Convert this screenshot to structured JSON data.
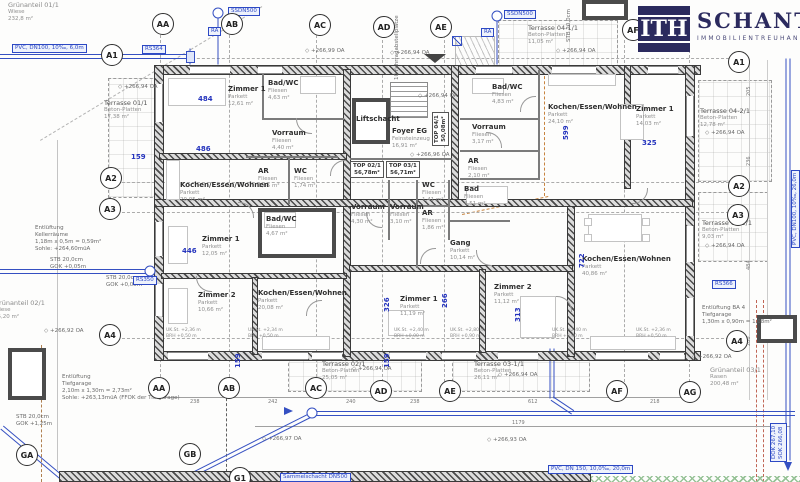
{
  "logo": {
    "monogram": "ITH",
    "name": "SCHANTL",
    "subtitle": "IMMOBILIENTREUHAND"
  },
  "colors": {
    "accent_navy": "#2b2a5e",
    "dim_blue": "#2433bd",
    "pipe_blue": "#3550c2"
  },
  "bubbles": [
    {
      "label": "AA",
      "x": 163,
      "y": 24
    },
    {
      "label": "AB",
      "x": 232,
      "y": 24
    },
    {
      "label": "AC",
      "x": 320,
      "y": 25
    },
    {
      "label": "AD",
      "x": 384,
      "y": 27
    },
    {
      "label": "AE",
      "x": 441,
      "y": 27
    },
    {
      "label": "AF",
      "x": 633,
      "y": 30
    },
    {
      "label": "AA",
      "x": 159,
      "y": 388
    },
    {
      "label": "AB",
      "x": 229,
      "y": 388
    },
    {
      "label": "AC",
      "x": 316,
      "y": 388
    },
    {
      "label": "AD",
      "x": 381,
      "y": 391
    },
    {
      "label": "AE",
      "x": 450,
      "y": 391
    },
    {
      "label": "AF",
      "x": 617,
      "y": 391
    },
    {
      "label": "AG",
      "x": 690,
      "y": 392
    },
    {
      "label": "A1",
      "x": 112,
      "y": 55
    },
    {
      "label": "A2",
      "x": 111,
      "y": 178
    },
    {
      "label": "A3",
      "x": 110,
      "y": 209
    },
    {
      "label": "A4",
      "x": 110,
      "y": 335
    },
    {
      "label": "A1",
      "x": 739,
      "y": 62
    },
    {
      "label": "A2",
      "x": 739,
      "y": 186
    },
    {
      "label": "A3",
      "x": 738,
      "y": 215
    },
    {
      "label": "A4",
      "x": 737,
      "y": 341
    },
    {
      "label": "GA",
      "x": 27,
      "y": 455
    },
    {
      "label": "GB",
      "x": 190,
      "y": 454
    },
    {
      "label": "G1",
      "x": 240,
      "y": 478
    }
  ],
  "rooms": [
    {
      "name": "Zimmer 1",
      "material": "Parkett",
      "area": "12,61 m²",
      "x": 228,
      "y": 86
    },
    {
      "name": "Bad/WC",
      "material": "Fliesen",
      "area": "4,63 m²",
      "x": 268,
      "y": 80
    },
    {
      "name": "Vorraum",
      "material": "Fliesen",
      "area": "4,40 m²",
      "x": 272,
      "y": 130
    },
    {
      "name": "AR",
      "material": "Fliesen",
      "area": "1,85 m²",
      "x": 258,
      "y": 168
    },
    {
      "name": "WC",
      "material": "Fliesen",
      "area": "1,74 m²",
      "x": 294,
      "y": 168
    },
    {
      "name": "Kochen/Essen/Wohnen",
      "material": "Parkett",
      "area": "20,05 m²",
      "x": 180,
      "y": 182
    },
    {
      "name": "Liftschacht",
      "material": "",
      "area": "",
      "x": 356,
      "y": 116
    },
    {
      "name": "Foyer EG",
      "material": "Feinsteinzeug",
      "area": "16,91 m²",
      "x": 392,
      "y": 128
    },
    {
      "name": "Bad/WC",
      "material": "Fliesen",
      "area": "4,83 m²",
      "x": 492,
      "y": 84
    },
    {
      "name": "Vorraum",
      "material": "Fliesen",
      "area": "3,17 m²",
      "x": 472,
      "y": 124
    },
    {
      "name": "AR",
      "material": "Fliesen",
      "area": "2,10 m²",
      "x": 468,
      "y": 158
    },
    {
      "name": "Kochen/Essen/Wohnen",
      "material": "Parkett",
      "area": "24,10 m²",
      "x": 548,
      "y": 104
    },
    {
      "name": "Zimmer 1",
      "material": "Parkett",
      "area": "14,03 m²",
      "x": 636,
      "y": 106
    },
    {
      "name": "Zimmer 1",
      "material": "Parkett",
      "area": "12,05 m²",
      "x": 202,
      "y": 236
    },
    {
      "name": "Zimmer 2",
      "material": "Parkett",
      "area": "10,66 m²",
      "x": 198,
      "y": 292
    },
    {
      "name": "Bad/WC",
      "material": "Fliesen",
      "area": "4,67 m²",
      "x": 266,
      "y": 216
    },
    {
      "name": "Kochen/Essen/Wohnen",
      "material": "Parkett",
      "area": "20,08 m²",
      "x": 258,
      "y": 290
    },
    {
      "name": "Vorraum",
      "material": "Fliesen",
      "area": "4,30 m²",
      "x": 351,
      "y": 204
    },
    {
      "name": "Vorraum",
      "material": "Fliesen",
      "area": "3,10 m²",
      "x": 390,
      "y": 204
    },
    {
      "name": "WC",
      "material": "Fliesen",
      "area": "1,41 m²",
      "x": 422,
      "y": 182
    },
    {
      "name": "AR",
      "material": "Fliesen",
      "area": "1,86 m²",
      "x": 422,
      "y": 210
    },
    {
      "name": "Bad",
      "material": "Fliesen",
      "area": "4,51 m²",
      "x": 464,
      "y": 186
    },
    {
      "name": "Gang",
      "material": "Parkett",
      "area": "10,14 m²",
      "x": 450,
      "y": 240
    },
    {
      "name": "Zimmer 1",
      "material": "Parkett",
      "area": "11,19 m²",
      "x": 400,
      "y": 296
    },
    {
      "name": "Zimmer 2",
      "material": "Parkett",
      "area": "11,12 m²",
      "x": 494,
      "y": 284
    },
    {
      "name": "Kochen/Essen/Wohnen",
      "material": "Parkett",
      "area": "40,86 m²",
      "x": 582,
      "y": 256
    }
  ],
  "tops": [
    {
      "label": "TOP 02/1",
      "area": "56,78m²",
      "x": 350,
      "y": 161,
      "vertical": false
    },
    {
      "label": "TOP 03/1",
      "area": "56,71m²",
      "x": 386,
      "y": 161,
      "vertical": false
    },
    {
      "label": "TOP 04/1",
      "area": "50,08m²",
      "x": 432,
      "y": 146,
      "vertical": true
    }
  ],
  "terraces": [
    {
      "name": "Terrasse 01/1",
      "material": "Beton-Platten",
      "area": "17,38 m²",
      "x": 104,
      "y": 100,
      "rx": 108,
      "ry": 78,
      "rw": 48,
      "rh": 118
    },
    {
      "name": "Terrasse 02/1",
      "material": "Beton-Platten",
      "area": "25,05 m²",
      "x": 322,
      "y": 361,
      "rx": 288,
      "ry": 358,
      "rw": 132,
      "rh": 32
    },
    {
      "name": "Terrasse 03-1/1",
      "material": "Beton-Platten",
      "area": "26,11 m²",
      "x": 474,
      "y": 361,
      "rx": 452,
      "ry": 358,
      "rw": 136,
      "rh": 32
    },
    {
      "name": "Terrasse 03-2/1",
      "material": "Beton-Platten",
      "area": "9,03 m²",
      "x": 702,
      "y": 220,
      "rx": 698,
      "ry": 192,
      "rw": 68,
      "rh": 68
    },
    {
      "name": "Terrasse 04-1/1",
      "material": "Beton-Platten",
      "area": "11,05 m²",
      "x": 528,
      "y": 25,
      "rx": 498,
      "ry": 20,
      "rw": 118,
      "rh": 46
    },
    {
      "name": "Terrasse 04-2/1",
      "material": "Beton-Platten",
      "area": "12,78 m²",
      "x": 700,
      "y": 108,
      "rx": 698,
      "ry": 80,
      "rw": 72,
      "rh": 100
    }
  ],
  "greens": [
    {
      "name": "Grünanteil 01/1",
      "material": "Wiese",
      "area": "232,8 m²",
      "x": 8,
      "y": 2
    },
    {
      "name": "Grünanteil 02/1",
      "material": "Wiese",
      "area": "75,20 m²",
      "x": -6,
      "y": 300
    },
    {
      "name": "Grünanteil 03/1",
      "material": "Rasen",
      "area": "200,48 m²",
      "x": 710,
      "y": 367
    }
  ],
  "dims": [
    {
      "text": "484",
      "x": 198,
      "y": 95,
      "v": false
    },
    {
      "text": "486",
      "x": 196,
      "y": 145,
      "v": false
    },
    {
      "text": "446",
      "x": 182,
      "y": 247,
      "v": false
    },
    {
      "text": "325",
      "x": 642,
      "y": 139,
      "v": false
    },
    {
      "text": "159",
      "x": 131,
      "y": 153,
      "v": false
    },
    {
      "text": "599",
      "x": 562,
      "y": 140,
      "v": true
    },
    {
      "text": "722",
      "x": 578,
      "y": 268,
      "v": true
    },
    {
      "text": "326",
      "x": 383,
      "y": 312,
      "v": true
    },
    {
      "text": "313",
      "x": 514,
      "y": 322,
      "v": true
    },
    {
      "text": "266",
      "x": 441,
      "y": 308,
      "v": true
    },
    {
      "text": "159",
      "x": 234,
      "y": 368,
      "v": true
    },
    {
      "text": "159",
      "x": 383,
      "y": 368,
      "v": true
    }
  ],
  "pipe_labels": [
    {
      "text": "PVC, DN100, 10‰, 6,0m",
      "x": 12,
      "y": 44,
      "v": false
    },
    {
      "text": "RS364",
      "x": 142,
      "y": 45,
      "v": false
    },
    {
      "text": "SSDN500",
      "x": 228,
      "y": 7,
      "v": false
    },
    {
      "text": "RA",
      "x": 208,
      "y": 27,
      "v": false
    },
    {
      "text": "SSDN500",
      "x": 504,
      "y": 10,
      "v": false
    },
    {
      "text": "RA",
      "x": 481,
      "y": 28,
      "v": false
    },
    {
      "text": "RS350",
      "x": 133,
      "y": 276,
      "v": false
    },
    {
      "text": "RS366",
      "x": 712,
      "y": 280,
      "v": false
    },
    {
      "text": "Sammelschacht DN500",
      "x": 280,
      "y": 473,
      "v": false
    },
    {
      "text": "PVC, DN 150, 10,0‰, 20,0m",
      "x": 548,
      "y": 465,
      "v": false
    },
    {
      "text": "PVC, DN100, 10‰, 26,0m",
      "x": 791,
      "y": 248,
      "v": true
    },
    {
      "text": "DOK 267,10\nSOK 266,08",
      "x": 770,
      "y": 462,
      "v": true
    }
  ],
  "elevations": [
    {
      "text": "+266,94 OA",
      "x": 118,
      "y": 84
    },
    {
      "text": "+266,94 OA",
      "x": 418,
      "y": 93
    },
    {
      "text": "+266,96 OA",
      "x": 410,
      "y": 152
    },
    {
      "text": "+266,99 OA",
      "x": 305,
      "y": 48
    },
    {
      "text": "+266,94 OA",
      "x": 390,
      "y": 50
    },
    {
      "text": "+266,94 OA",
      "x": 556,
      "y": 48
    },
    {
      "text": "+266,94 OA",
      "x": 705,
      "y": 130
    },
    {
      "text": "+266,94 OA",
      "x": 705,
      "y": 243
    },
    {
      "text": "+266,94 OA",
      "x": 352,
      "y": 366
    },
    {
      "text": "+266,94 OA",
      "x": 498,
      "y": 372
    },
    {
      "text": "+266,92 OA",
      "x": 44,
      "y": 328
    },
    {
      "text": "+266,92 OA",
      "x": 692,
      "y": 354
    },
    {
      "text": "+266,97 OA",
      "x": 262,
      "y": 436
    },
    {
      "text": "+266,93 OA",
      "x": 487,
      "y": 437
    }
  ],
  "notes": [
    {
      "text": "Entlüftung\nKellerräume\n1,18m x 0,5m = 0,59m²\nSohle: +264,60müA",
      "x": 35,
      "y": 225,
      "v": false
    },
    {
      "text": "STB 20,0cm\nGOK +0,05m",
      "x": 50,
      "y": 257,
      "v": false
    },
    {
      "text": "STB 20,0cm\nGOK +0,05m",
      "x": 106,
      "y": 275,
      "v": false
    },
    {
      "text": "Entlüftung\nTiefgarage\n2,10m x 1,30m = 2,73m²\nSohle: +263,13müA (FFOK der Tiefgarage)",
      "x": 62,
      "y": 374,
      "v": false
    },
    {
      "text": "STB 20,0cm\nGOK +1,25m",
      "x": 16,
      "y": 414,
      "v": false
    },
    {
      "text": "Entlüftung BA 4\nTiefgarage\n1,30m x 0,90m = 1,08m²",
      "x": 702,
      "y": 305,
      "v": false
    },
    {
      "text": "10 Fahrradabstellplätze",
      "x": 394,
      "y": 80,
      "v": true
    },
    {
      "text": "STB 20,0cm",
      "x": 566,
      "y": 42,
      "v": true
    }
  ],
  "window_notes": [
    {
      "text": "UK.St. +2,36 m\nBRH +0,50 m",
      "x": 166,
      "y": 328
    },
    {
      "text": "UK.St. +2,34 m\nBRH +0,50 m",
      "x": 248,
      "y": 328
    },
    {
      "text": "UK.St. +2,40 m\nBRH ±0,00 m",
      "x": 394,
      "y": 328
    },
    {
      "text": "UK.St. +2,80 m\nBRH +0,90 m",
      "x": 450,
      "y": 328
    },
    {
      "text": "UK.St. +2,40 m\nBRH +0,90 m",
      "x": 552,
      "y": 328
    },
    {
      "text": "UK.St. +2,36 m\nBRH +0,50 m",
      "x": 636,
      "y": 328
    }
  ],
  "chain_numbers": [
    {
      "text": "238",
      "x": 190,
      "y": 399
    },
    {
      "text": "242",
      "x": 268,
      "y": 399
    },
    {
      "text": "240",
      "x": 346,
      "y": 399
    },
    {
      "text": "238",
      "x": 410,
      "y": 399
    },
    {
      "text": "612",
      "x": 528,
      "y": 399
    },
    {
      "text": "218",
      "x": 650,
      "y": 399
    },
    {
      "text": "1179",
      "x": 512,
      "y": 420
    }
  ],
  "side_numbers": [
    {
      "text": "205",
      "x": 746,
      "y": 96
    },
    {
      "text": "236",
      "x": 746,
      "y": 166
    },
    {
      "text": "484",
      "x": 746,
      "y": 270
    },
    {
      "text": "280",
      "x": 746,
      "y": 346
    }
  ]
}
